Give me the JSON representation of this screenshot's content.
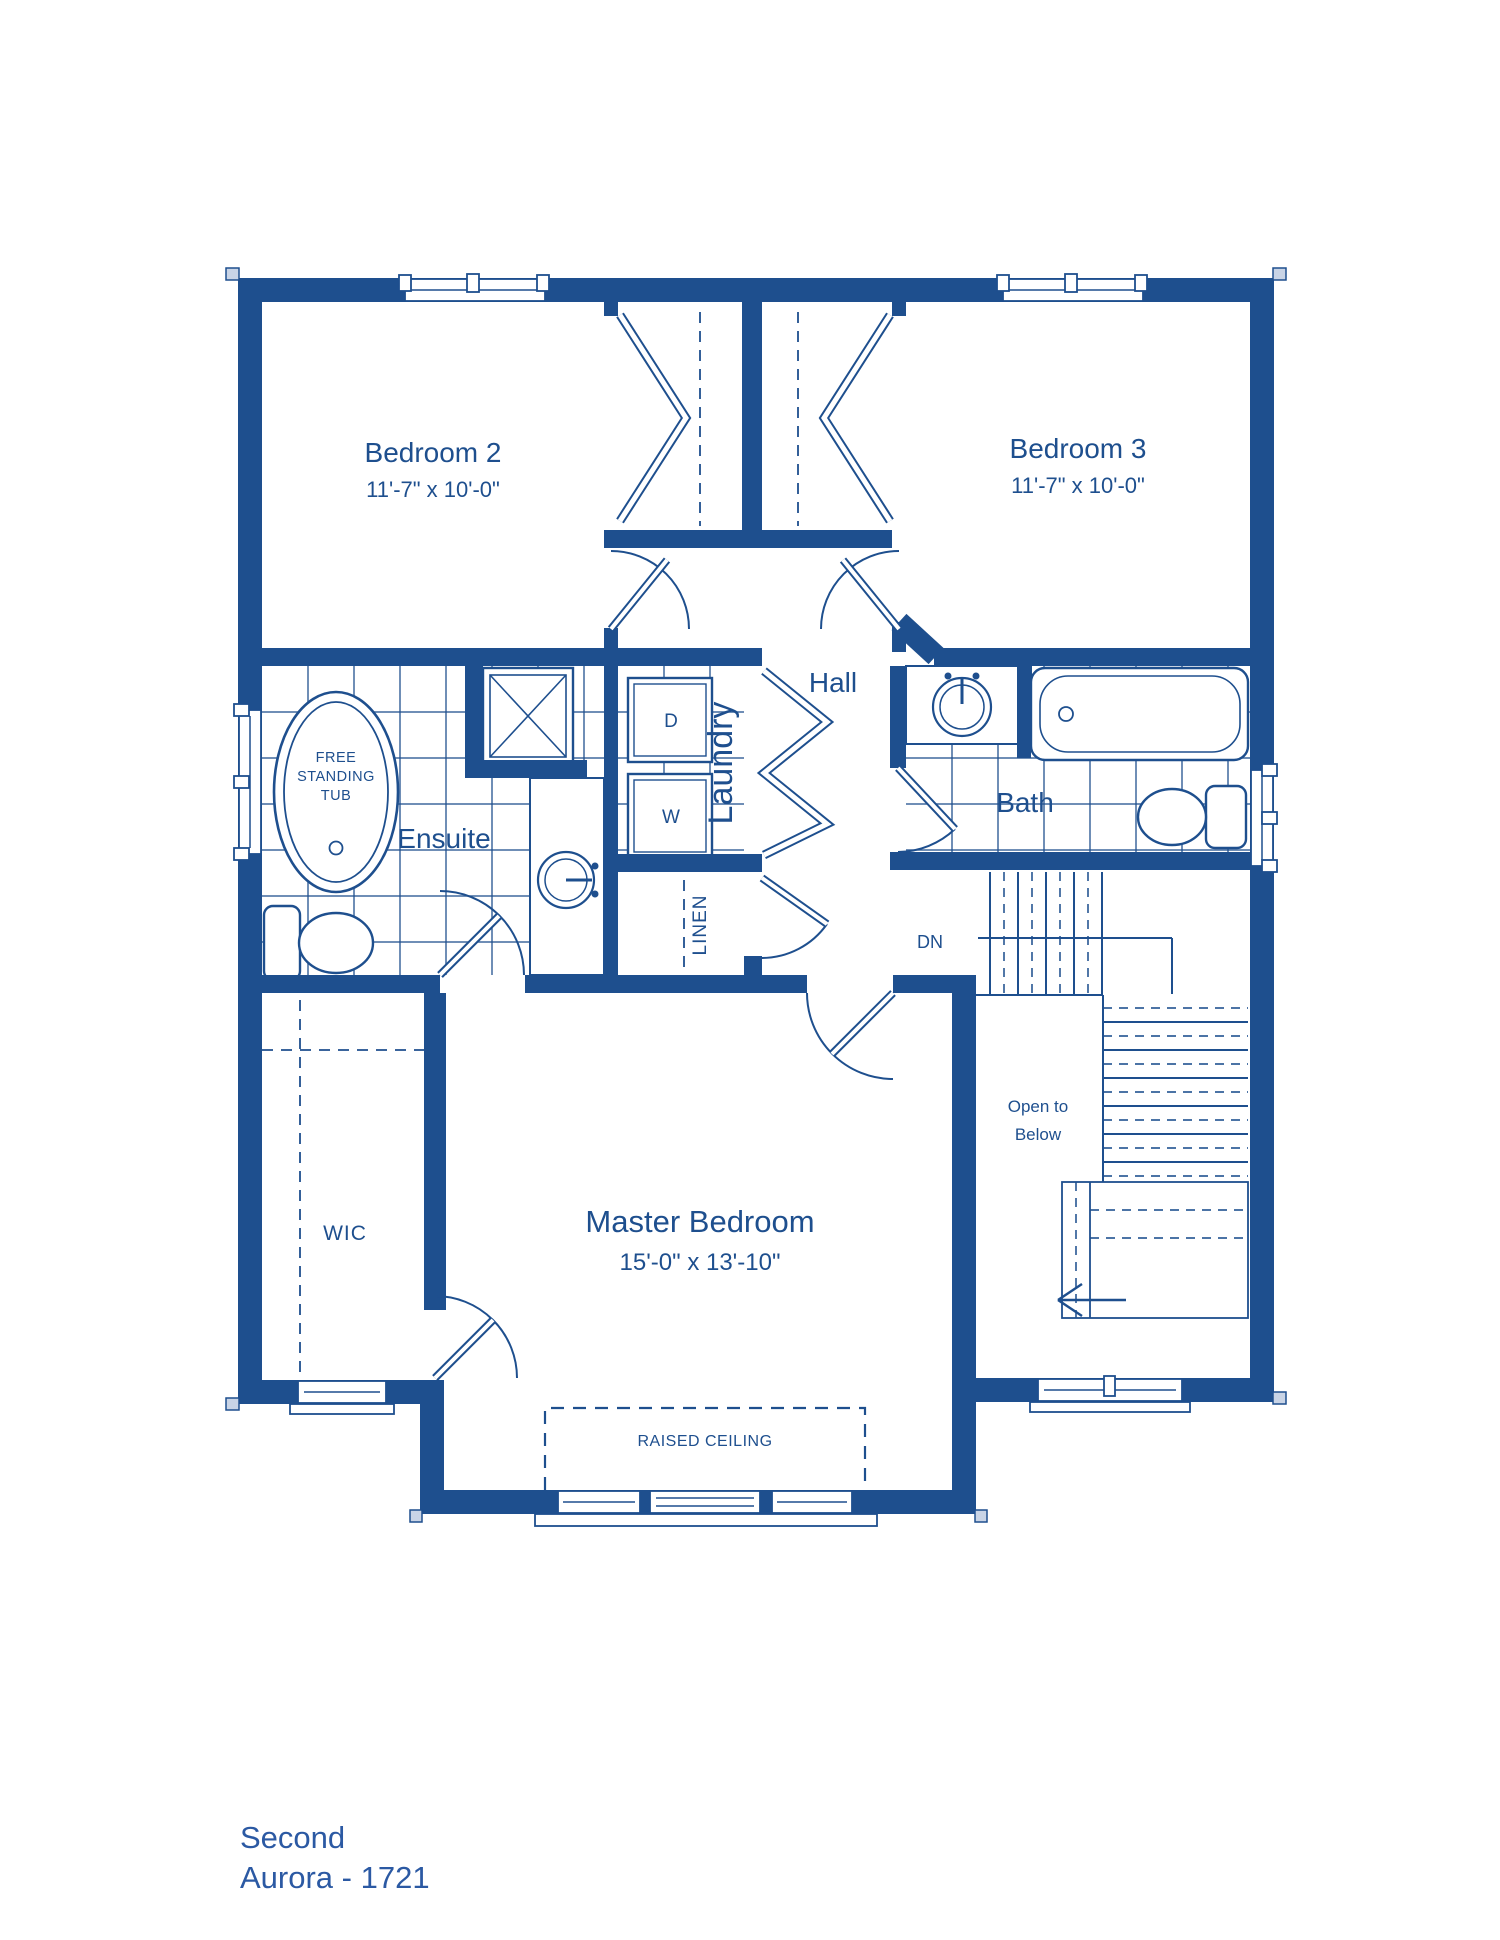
{
  "title": {
    "floor": "Second",
    "model": "Aurora - 1721"
  },
  "colors": {
    "wall": "#1e4f8e",
    "footer_text": "#2b59a3",
    "background": "#ffffff",
    "cap_fill": "#c9d4e6"
  },
  "rooms": {
    "bedroom2": {
      "label": "Bedroom 2",
      "dims": "11'-7\" x 10'-0\""
    },
    "bedroom3": {
      "label": "Bedroom 3",
      "dims": "11'-7\" x 10'-0\""
    },
    "hall": {
      "label": "Hall"
    },
    "laundry": {
      "label": "Laundry",
      "dryer": "D",
      "washer": "W"
    },
    "linen": {
      "label": "LINEN"
    },
    "ensuite": {
      "label": "Ensuite",
      "tub_line1": "FREE",
      "tub_line2": "STANDING",
      "tub_line3": "TUB"
    },
    "bath": {
      "label": "Bath"
    },
    "stairs": {
      "down": "DN",
      "open_line1": "Open to",
      "open_line2": "Below"
    },
    "wic": {
      "label": "WIC"
    },
    "master": {
      "label": "Master Bedroom",
      "dims": "15'-0\" x 13'-10\"",
      "ceiling": "RAISED CEILING"
    }
  }
}
